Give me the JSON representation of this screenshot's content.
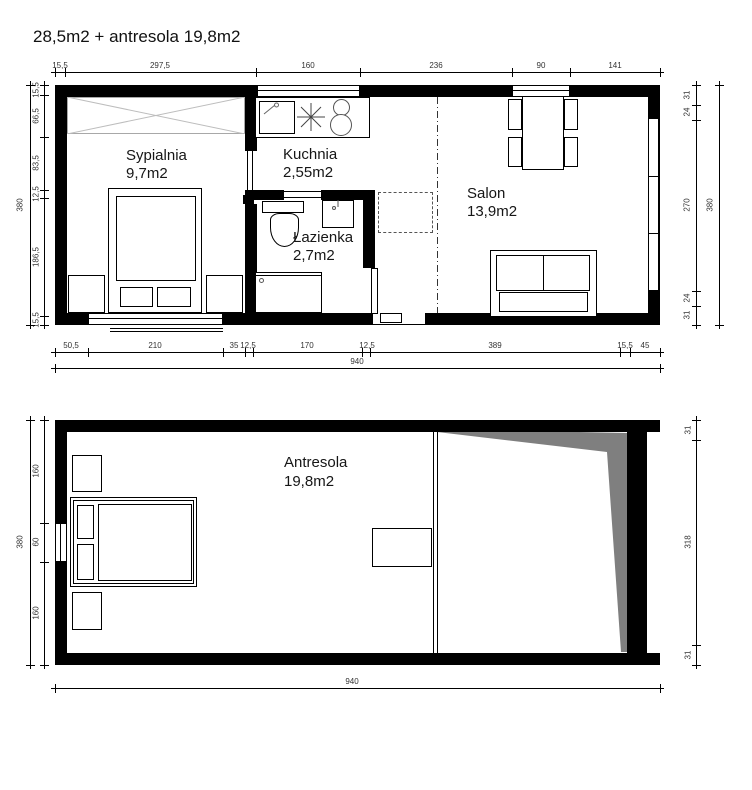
{
  "title": "28,5m2 + antresola 19,8m2",
  "colors": {
    "wall": "#000000",
    "slope_gray": "#7f7f7f"
  },
  "rooms": {
    "sypialnia": {
      "name": "Sypialnia",
      "area": "9,7m2"
    },
    "kuchnia": {
      "name": "Kuchnia",
      "area": "2,55m2"
    },
    "lazienka": {
      "name": "Łazienka",
      "area": "2,7m2"
    },
    "salon": {
      "name": "Salon",
      "area": "13,9m2"
    },
    "antresola": {
      "name": "Antresola",
      "area": "19,8m2"
    }
  },
  "plan1": {
    "top": [
      "15,5",
      "297,5",
      "160",
      "236",
      "90",
      "141"
    ],
    "bottom": [
      "50,5",
      "210",
      "35",
      "12,5",
      "170",
      "12,5",
      "389",
      "15,5",
      "45"
    ],
    "bottom_total": "940",
    "left": [
      "15,5",
      "66,5",
      "83,5",
      "12,5",
      "186,5",
      "15,5"
    ],
    "left_total": "380",
    "right": [
      "31",
      "24",
      "270",
      "24",
      "31"
    ],
    "right_total": "380"
  },
  "plan2": {
    "left": [
      "160",
      "60",
      "160"
    ],
    "left_total": "380",
    "right": [
      "31",
      "318",
      "31"
    ],
    "bottom_total": "940"
  }
}
